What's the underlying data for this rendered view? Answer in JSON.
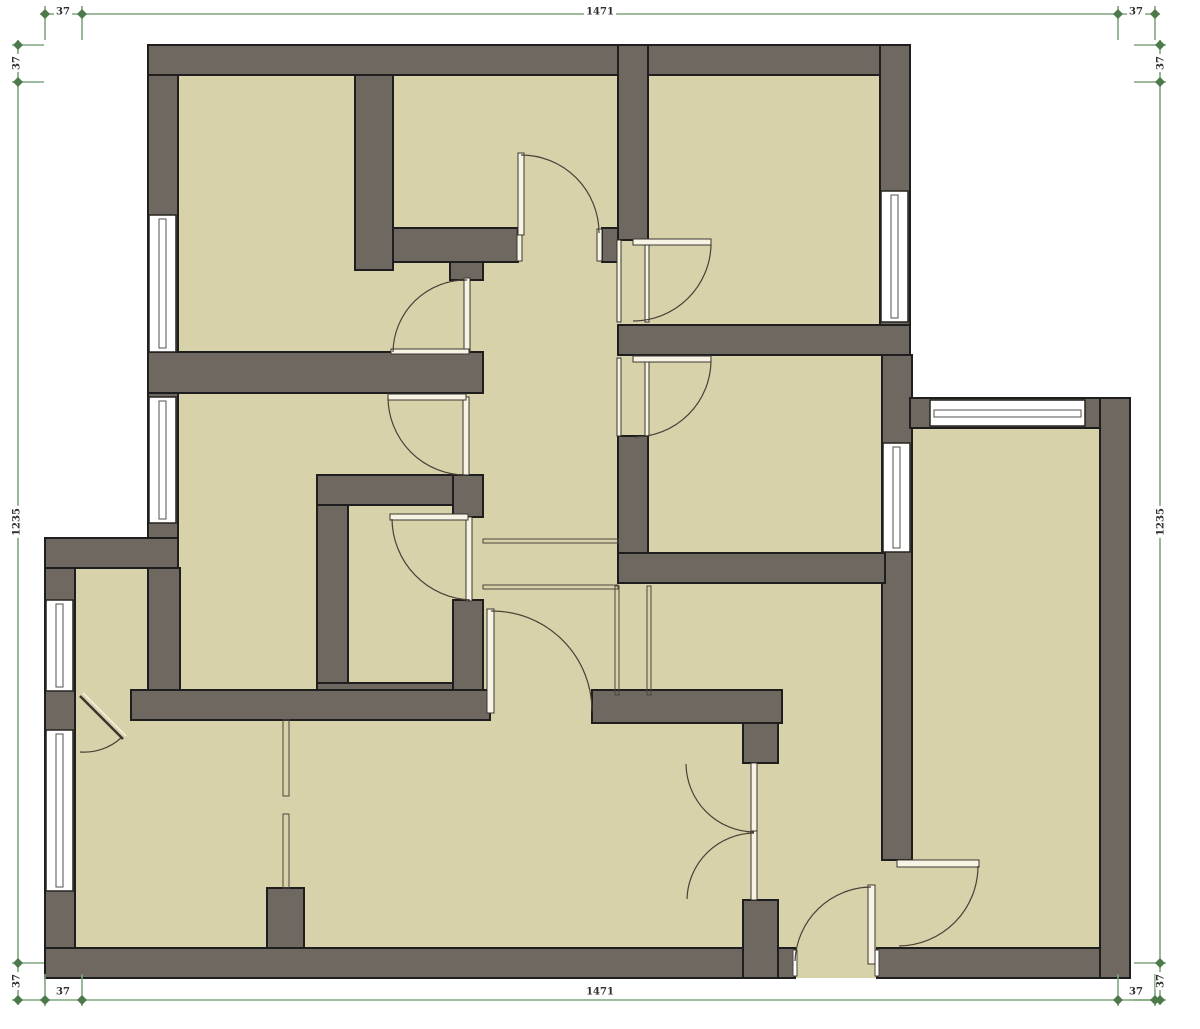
{
  "title": "floor-plan",
  "dimensions": {
    "top": {
      "left": "37",
      "middle": "1471",
      "right": "37"
    },
    "bottom": {
      "left": "37",
      "middle": "1471",
      "right": "37"
    },
    "left": {
      "top": "37",
      "middle": "1235",
      "bottom": "37"
    },
    "right": {
      "top": "37",
      "middle": "1235",
      "bottom": "37"
    }
  },
  "colors": {
    "wall": "#6F6860",
    "wall_outline": "#1e1e1e",
    "floor": "#D8D2AA",
    "dimension": "#7FA67D",
    "marker": "#4C7A4A",
    "text": "#2e2e2e"
  }
}
